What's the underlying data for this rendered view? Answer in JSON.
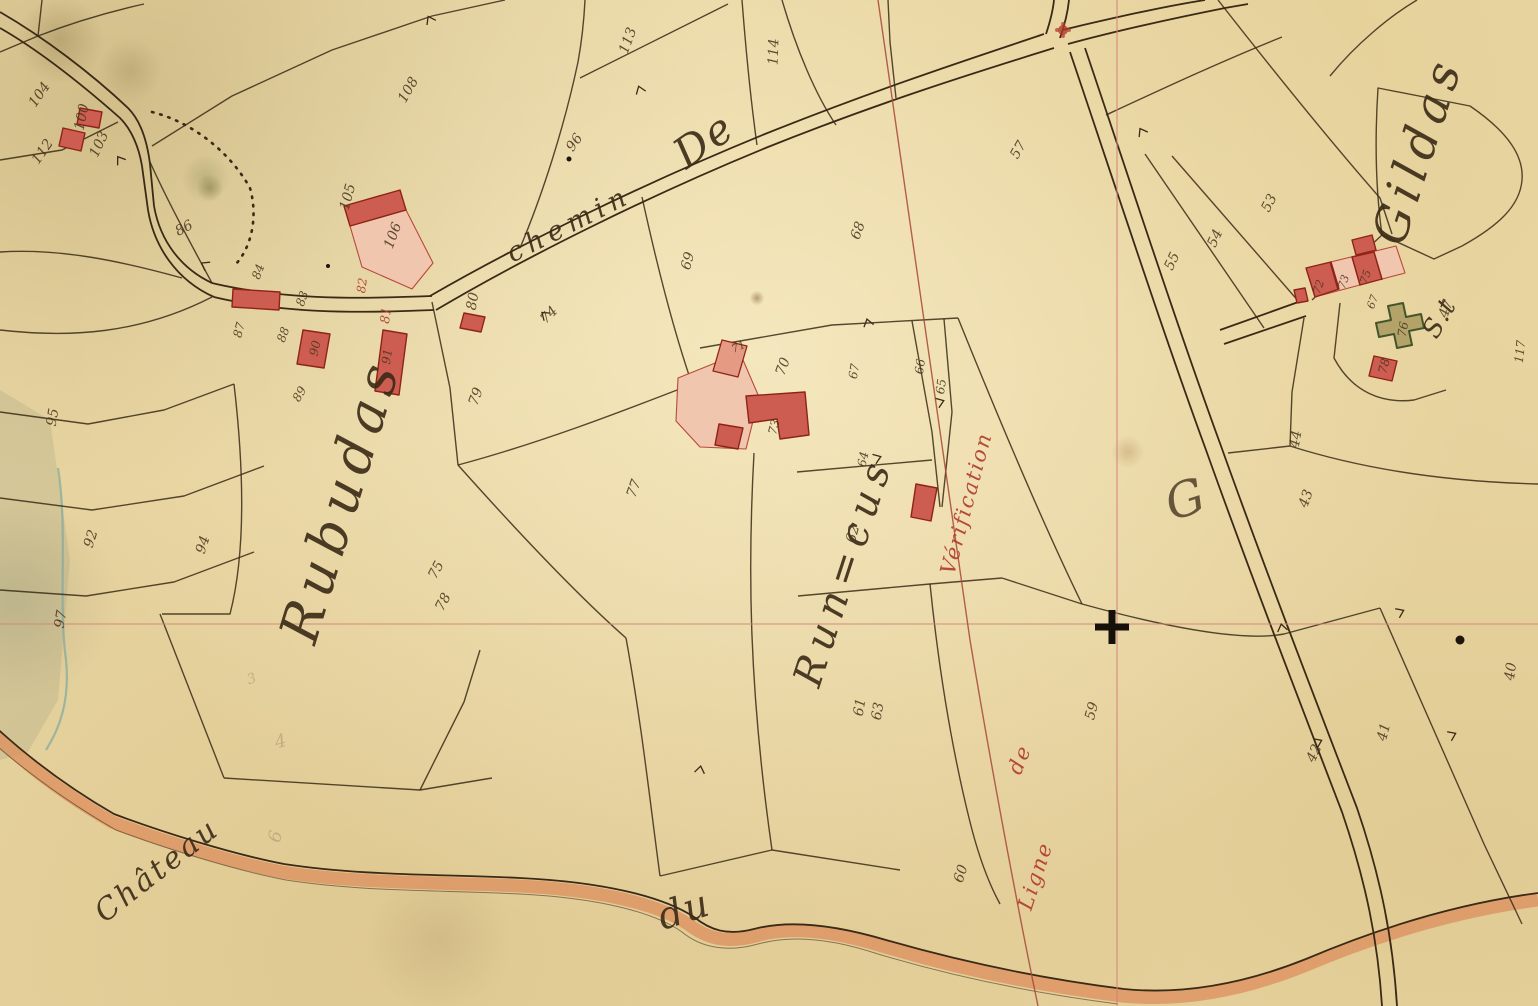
{
  "map": {
    "colors": {
      "parchment": "#e9d6a2",
      "ink": "#3a2a16",
      "red_ink": "#b0392c",
      "faint_pencil": "#a8956d",
      "building_fill": "#cd5c51",
      "building_wall": "#8e2418",
      "yard_pink": "#f0c6ae",
      "yard_dark": "#e59a84",
      "chapel_fill": "#b3a369",
      "chapel_stroke": "#44552b",
      "grid_red": "#d4847a",
      "verification_red": "#a8473b",
      "road_orange": "#dd9260",
      "stream_teal": "#7fa89f"
    },
    "region_labels": [
      {
        "id": "rubudas",
        "text": "Rubudas",
        "x": 358,
        "y": 505,
        "rot": -73,
        "size": 54,
        "ls": 8,
        "color": "ink"
      },
      {
        "id": "runcus",
        "text": "Run=cus",
        "x": 856,
        "y": 575,
        "rot": -72,
        "size": 40,
        "ls": 8,
        "color": "ink"
      },
      {
        "id": "chemin",
        "text": "chemin",
        "x": 573,
        "y": 232,
        "rot": -27,
        "size": 27,
        "ls": 6,
        "color": "ink"
      },
      {
        "id": "chemin-de",
        "text": "De",
        "x": 712,
        "y": 152,
        "rot": -35,
        "size": 42,
        "ls": 2,
        "color": "ink"
      },
      {
        "id": "st",
        "text": "S.t",
        "x": 1447,
        "y": 322,
        "rot": -60,
        "size": 26,
        "ls": 2,
        "color": "ink"
      },
      {
        "id": "gildas",
        "text": "Gildas",
        "x": 1433,
        "y": 155,
        "rot": -72,
        "size": 48,
        "ls": 7,
        "color": "ink"
      },
      {
        "id": "chateau",
        "text": "Château",
        "x": 163,
        "y": 878,
        "rot": -38,
        "size": 30,
        "ls": 3,
        "color": "ink"
      },
      {
        "id": "du",
        "text": "du",
        "x": 688,
        "y": 922,
        "rot": -18,
        "size": 38,
        "ls": 2,
        "color": "ink"
      },
      {
        "id": "ligne",
        "text": "Ligne",
        "x": 1042,
        "y": 878,
        "rot": -72,
        "size": 21,
        "ls": 2,
        "color": "red"
      },
      {
        "id": "ligne-de",
        "text": "de",
        "x": 1026,
        "y": 762,
        "rot": -68,
        "size": 21,
        "ls": 2,
        "color": "red"
      },
      {
        "id": "verification",
        "text": "Vérification",
        "x": 973,
        "y": 505,
        "rot": -75,
        "size": 21,
        "ls": 2,
        "color": "red"
      },
      {
        "id": "flourish-g",
        "text": "G",
        "x": 1190,
        "y": 515,
        "rot": -18,
        "size": 48,
        "ls": 0,
        "color": "ink",
        "opacity": 0.75
      }
    ],
    "parcel_numbers": [
      {
        "n": "104",
        "x": 43,
        "y": 97,
        "rot": -55
      },
      {
        "n": "100",
        "x": 86,
        "y": 118,
        "rot": -78
      },
      {
        "n": "103",
        "x": 103,
        "y": 146,
        "rot": -65
      },
      {
        "n": "112",
        "x": 46,
        "y": 154,
        "rot": -55
      },
      {
        "n": "108",
        "x": 412,
        "y": 92,
        "rot": -60
      },
      {
        "n": "113",
        "x": 632,
        "y": 42,
        "rot": -70
      },
      {
        "n": "114",
        "x": 778,
        "y": 52,
        "rot": -88
      },
      {
        "n": "96",
        "x": 578,
        "y": 145,
        "rot": -55
      },
      {
        "n": "86",
        "x": 186,
        "y": 232,
        "rot": -28
      },
      {
        "n": "105",
        "x": 352,
        "y": 198,
        "rot": -75
      },
      {
        "n": "106",
        "x": 397,
        "y": 237,
        "rot": -70
      },
      {
        "n": "80",
        "x": 477,
        "y": 302,
        "rot": -80
      },
      {
        "n": "84",
        "x": 262,
        "y": 273,
        "rot": -70,
        "size": 12
      },
      {
        "n": "83",
        "x": 306,
        "y": 300,
        "rot": -70,
        "size": 12
      },
      {
        "n": "87",
        "x": 243,
        "y": 331,
        "rot": -75,
        "size": 12
      },
      {
        "n": "88",
        "x": 287,
        "y": 336,
        "rot": -70,
        "size": 12
      },
      {
        "n": "89",
        "x": 303,
        "y": 396,
        "rot": -60,
        "size": 12
      },
      {
        "n": "90",
        "x": 319,
        "y": 349,
        "rot": -78,
        "size": 12
      },
      {
        "n": "91",
        "x": 391,
        "y": 357,
        "rot": -82,
        "size": 12
      },
      {
        "n": "74",
        "x": 552,
        "y": 318,
        "rot": -45
      },
      {
        "n": "79",
        "x": 480,
        "y": 398,
        "rot": -70
      },
      {
        "n": "69",
        "x": 692,
        "y": 262,
        "rot": -75
      },
      {
        "n": "68",
        "x": 862,
        "y": 232,
        "rot": -70
      },
      {
        "n": "71",
        "x": 740,
        "y": 350,
        "rot": -25,
        "size": 11
      },
      {
        "n": "70",
        "x": 787,
        "y": 368,
        "rot": -70
      },
      {
        "n": "73",
        "x": 778,
        "y": 428,
        "rot": -75,
        "size": 12
      },
      {
        "n": "67",
        "x": 858,
        "y": 372,
        "rot": -80,
        "size": 12
      },
      {
        "n": "66",
        "x": 924,
        "y": 367,
        "rot": -82,
        "size": 12
      },
      {
        "n": "65",
        "x": 945,
        "y": 387,
        "rot": -82,
        "size": 12
      },
      {
        "n": "64",
        "x": 867,
        "y": 460,
        "rot": -78,
        "size": 12
      },
      {
        "n": "62",
        "x": 857,
        "y": 535,
        "rot": -75
      },
      {
        "n": "61",
        "x": 864,
        "y": 708,
        "rot": -80
      },
      {
        "n": "63",
        "x": 882,
        "y": 712,
        "rot": -80
      },
      {
        "n": "60",
        "x": 965,
        "y": 875,
        "rot": -72
      },
      {
        "n": "59",
        "x": 1096,
        "y": 712,
        "rot": -75
      },
      {
        "n": "57",
        "x": 1022,
        "y": 152,
        "rot": -60
      },
      {
        "n": "53",
        "x": 1273,
        "y": 205,
        "rot": -62
      },
      {
        "n": "54",
        "x": 1219,
        "y": 240,
        "rot": -65
      },
      {
        "n": "55",
        "x": 1176,
        "y": 263,
        "rot": -65
      },
      {
        "n": "95",
        "x": 57,
        "y": 418,
        "rot": -80
      },
      {
        "n": "92",
        "x": 95,
        "y": 540,
        "rot": -72
      },
      {
        "n": "94",
        "x": 207,
        "y": 546,
        "rot": -72
      },
      {
        "n": "97",
        "x": 65,
        "y": 620,
        "rot": -80
      },
      {
        "n": "77",
        "x": 638,
        "y": 490,
        "rot": -70
      },
      {
        "n": "75",
        "x": 440,
        "y": 572,
        "rot": -62
      },
      {
        "n": "78",
        "x": 447,
        "y": 604,
        "rot": -62
      },
      {
        "n": "47",
        "x": 1450,
        "y": 310,
        "rot": -72
      },
      {
        "n": "117",
        "x": 1524,
        "y": 352,
        "rot": -84,
        "size": 12
      },
      {
        "n": "72",
        "x": 1322,
        "y": 288,
        "rot": -70,
        "size": 11
      },
      {
        "n": "73",
        "x": 1347,
        "y": 283,
        "rot": -70,
        "size": 11
      },
      {
        "n": "75",
        "x": 1369,
        "y": 278,
        "rot": -70,
        "size": 11
      },
      {
        "n": "67",
        "x": 1376,
        "y": 303,
        "rot": -70,
        "size": 11
      },
      {
        "n": "76",
        "x": 1407,
        "y": 330,
        "rot": -80,
        "size": 12
      },
      {
        "n": "78",
        "x": 1388,
        "y": 367,
        "rot": -75,
        "size": 12
      },
      {
        "n": "44",
        "x": 1300,
        "y": 440,
        "rot": -80
      },
      {
        "n": "43",
        "x": 1310,
        "y": 500,
        "rot": -70
      },
      {
        "n": "41",
        "x": 1388,
        "y": 733,
        "rot": -75
      },
      {
        "n": "40",
        "x": 1515,
        "y": 672,
        "rot": -82
      },
      {
        "n": "42",
        "x": 1318,
        "y": 755,
        "rot": -65
      },
      {
        "n": "81",
        "x": 390,
        "y": 316,
        "rot": -82,
        "size": 13,
        "color": "red"
      },
      {
        "n": "82",
        "x": 366,
        "y": 286,
        "rot": -82,
        "size": 12,
        "color": "red"
      },
      {
        "n": "3",
        "x": 253,
        "y": 683,
        "rot": -20,
        "color": "faint"
      },
      {
        "n": "4",
        "x": 282,
        "y": 747,
        "rot": -15,
        "color": "faint",
        "size": 18
      },
      {
        "n": "6",
        "x": 281,
        "y": 838,
        "rot": -75,
        "color": "faint",
        "size": 18
      }
    ],
    "symbols": [
      {
        "type": "survey-cross",
        "x": 1112,
        "y": 627
      },
      {
        "type": "calvary",
        "x": 1063,
        "y": 30
      },
      {
        "type": "ink-dot",
        "x": 1460,
        "y": 640,
        "r": 4.5
      },
      {
        "type": "ink-dot",
        "x": 569,
        "y": 159,
        "r": 2.5
      },
      {
        "type": "ink-dot",
        "x": 328,
        "y": 266,
        "r": 2
      }
    ]
  }
}
